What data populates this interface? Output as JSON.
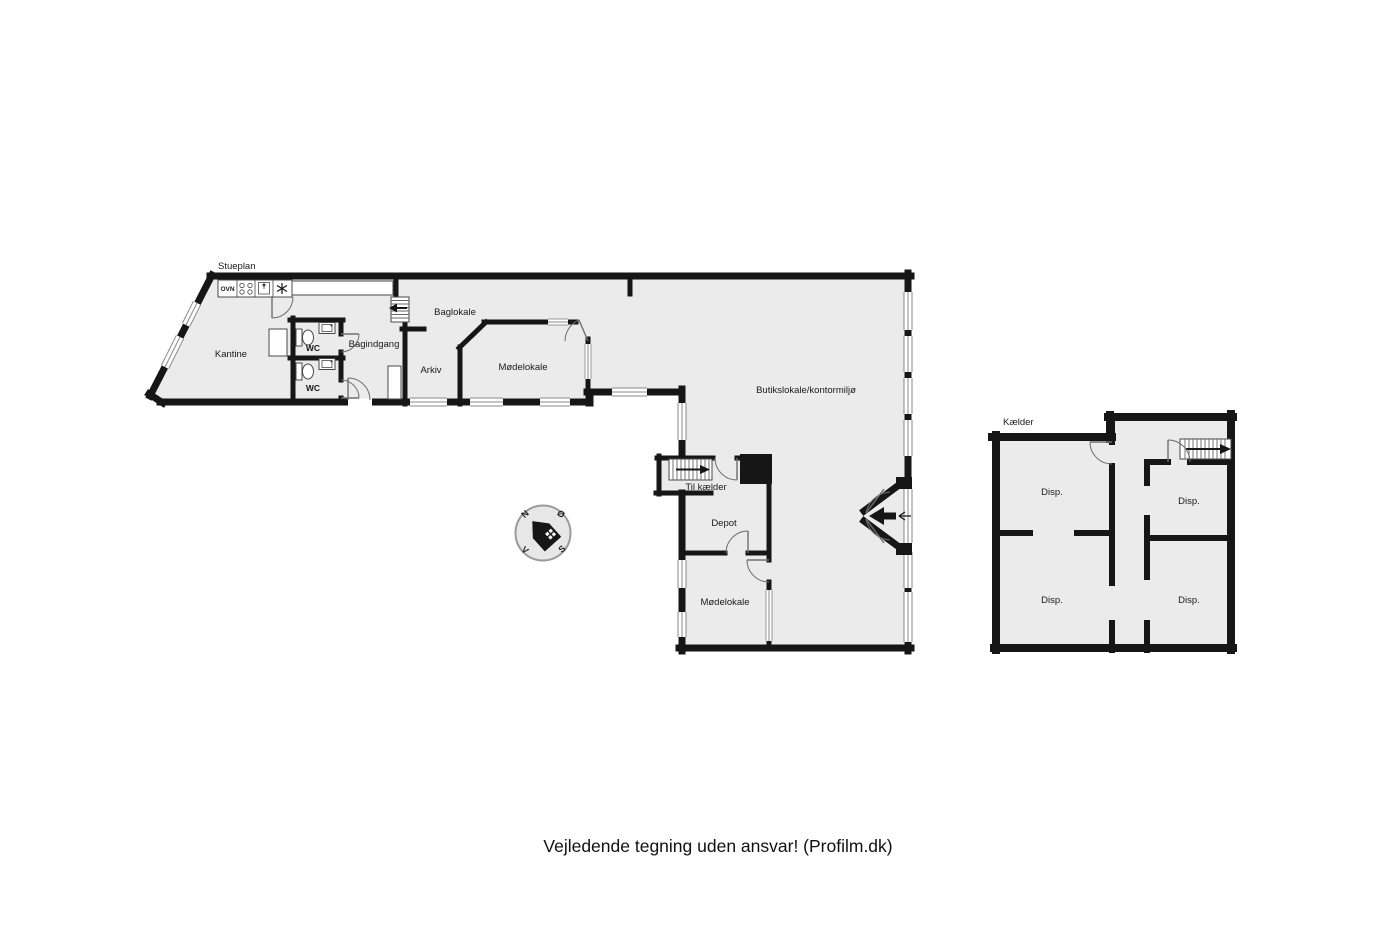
{
  "page": {
    "footer": "Vejledende tegning uden ansvar! (Profilm.dk)"
  },
  "colors": {
    "background": "#ffffff",
    "floor_fill": "#ebebeb",
    "wall": "#161616",
    "text": "#1a1a1a"
  },
  "stueplan": {
    "title": "Stueplan",
    "rooms": [
      {
        "label": "Kantine"
      },
      {
        "label": "WC"
      },
      {
        "label": "WC"
      },
      {
        "label": "Bagindgang"
      },
      {
        "label": "Baglokale"
      },
      {
        "label": "Arkiv"
      },
      {
        "label": "Mødelokale"
      },
      {
        "label": "Butikslokale/kontormiljø"
      },
      {
        "label": "Til kælder"
      },
      {
        "label": "Depot"
      },
      {
        "label": "Mødelokale"
      }
    ],
    "kitchen": {
      "oven_label": "OVN"
    }
  },
  "kaelder": {
    "title": "Kælder",
    "rooms": [
      {
        "label": "Disp."
      },
      {
        "label": "Disp."
      },
      {
        "label": "Disp."
      },
      {
        "label": "Disp."
      }
    ]
  },
  "compass": {
    "n": "N",
    "e": "Ø",
    "s": "S",
    "w": "V"
  }
}
